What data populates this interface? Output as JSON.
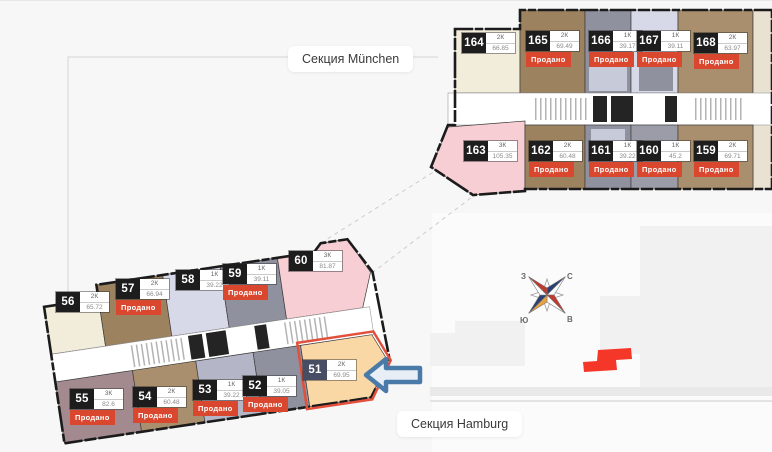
{
  "sold_label": "Продано",
  "sections": [
    {
      "id": "muenchen",
      "label": "Секция München",
      "apartments": [
        {
          "id": "164",
          "type": "2К",
          "area": "66.85",
          "sold": false
        },
        {
          "id": "165",
          "type": "2К",
          "area": "69.49",
          "sold": true
        },
        {
          "id": "166",
          "type": "1К",
          "area": "39.17",
          "sold": true
        },
        {
          "id": "167",
          "type": "1К",
          "area": "39.11",
          "sold": true
        },
        {
          "id": "168",
          "type": "2К",
          "area": "63.97",
          "sold": true
        },
        {
          "id": "163",
          "type": "3К",
          "area": "105.35",
          "sold": false
        },
        {
          "id": "162",
          "type": "2К",
          "area": "60.48",
          "sold": true
        },
        {
          "id": "161",
          "type": "1К",
          "area": "39.22",
          "sold": true
        },
        {
          "id": "160",
          "type": "1К",
          "area": "45.2",
          "sold": true
        },
        {
          "id": "159",
          "type": "2К",
          "area": "69.71",
          "sold": true
        }
      ]
    },
    {
      "id": "hamburg",
      "label": "Секция Hamburg",
      "apartments": [
        {
          "id": "56",
          "type": "2К",
          "area": "65.72",
          "sold": false
        },
        {
          "id": "57",
          "type": "2К",
          "area": "66.94",
          "sold": true
        },
        {
          "id": "58",
          "type": "1К",
          "area": "39.22",
          "sold": false
        },
        {
          "id": "59",
          "type": "1К",
          "area": "39.11",
          "sold": true
        },
        {
          "id": "60",
          "type": "3К",
          "area": "81.87",
          "sold": false
        },
        {
          "id": "55",
          "type": "3К",
          "area": "82.6",
          "sold": true
        },
        {
          "id": "54",
          "type": "2К",
          "area": "60.48",
          "sold": true
        },
        {
          "id": "53",
          "type": "1К",
          "area": "39.22",
          "sold": true
        },
        {
          "id": "52",
          "type": "1К",
          "area": "39.05",
          "sold": true
        },
        {
          "id": "51",
          "type": "2К",
          "area": "69.95",
          "sold": false,
          "highlighted": true
        }
      ]
    }
  ],
  "compass": {
    "letters": {
      "north": "С",
      "east": "В",
      "south": "Ю",
      "west": "З"
    }
  },
  "colors": {
    "sold-badge": "#d9472f",
    "number-badge": "#1d1d1d",
    "apartment51-badge": "#474d63",
    "highlight-outline": "#e2503c",
    "arrow-blue": "#4a7aa8",
    "unit-cream": "#f2ecdb",
    "unit-brown": "#9d8260",
    "unit-tan": "#a98f6d",
    "unit-lavender": "#d8d9e8",
    "unit-lavender-mid": "#b4b6c8",
    "unit-gray": "#8f919f",
    "unit-gray-light": "#9b9ca8",
    "unit-pink": "#f7ced3",
    "unit-mauve": "#a28a8e",
    "unit-peach": "#fad8a6",
    "map-red": "#f5372a"
  }
}
